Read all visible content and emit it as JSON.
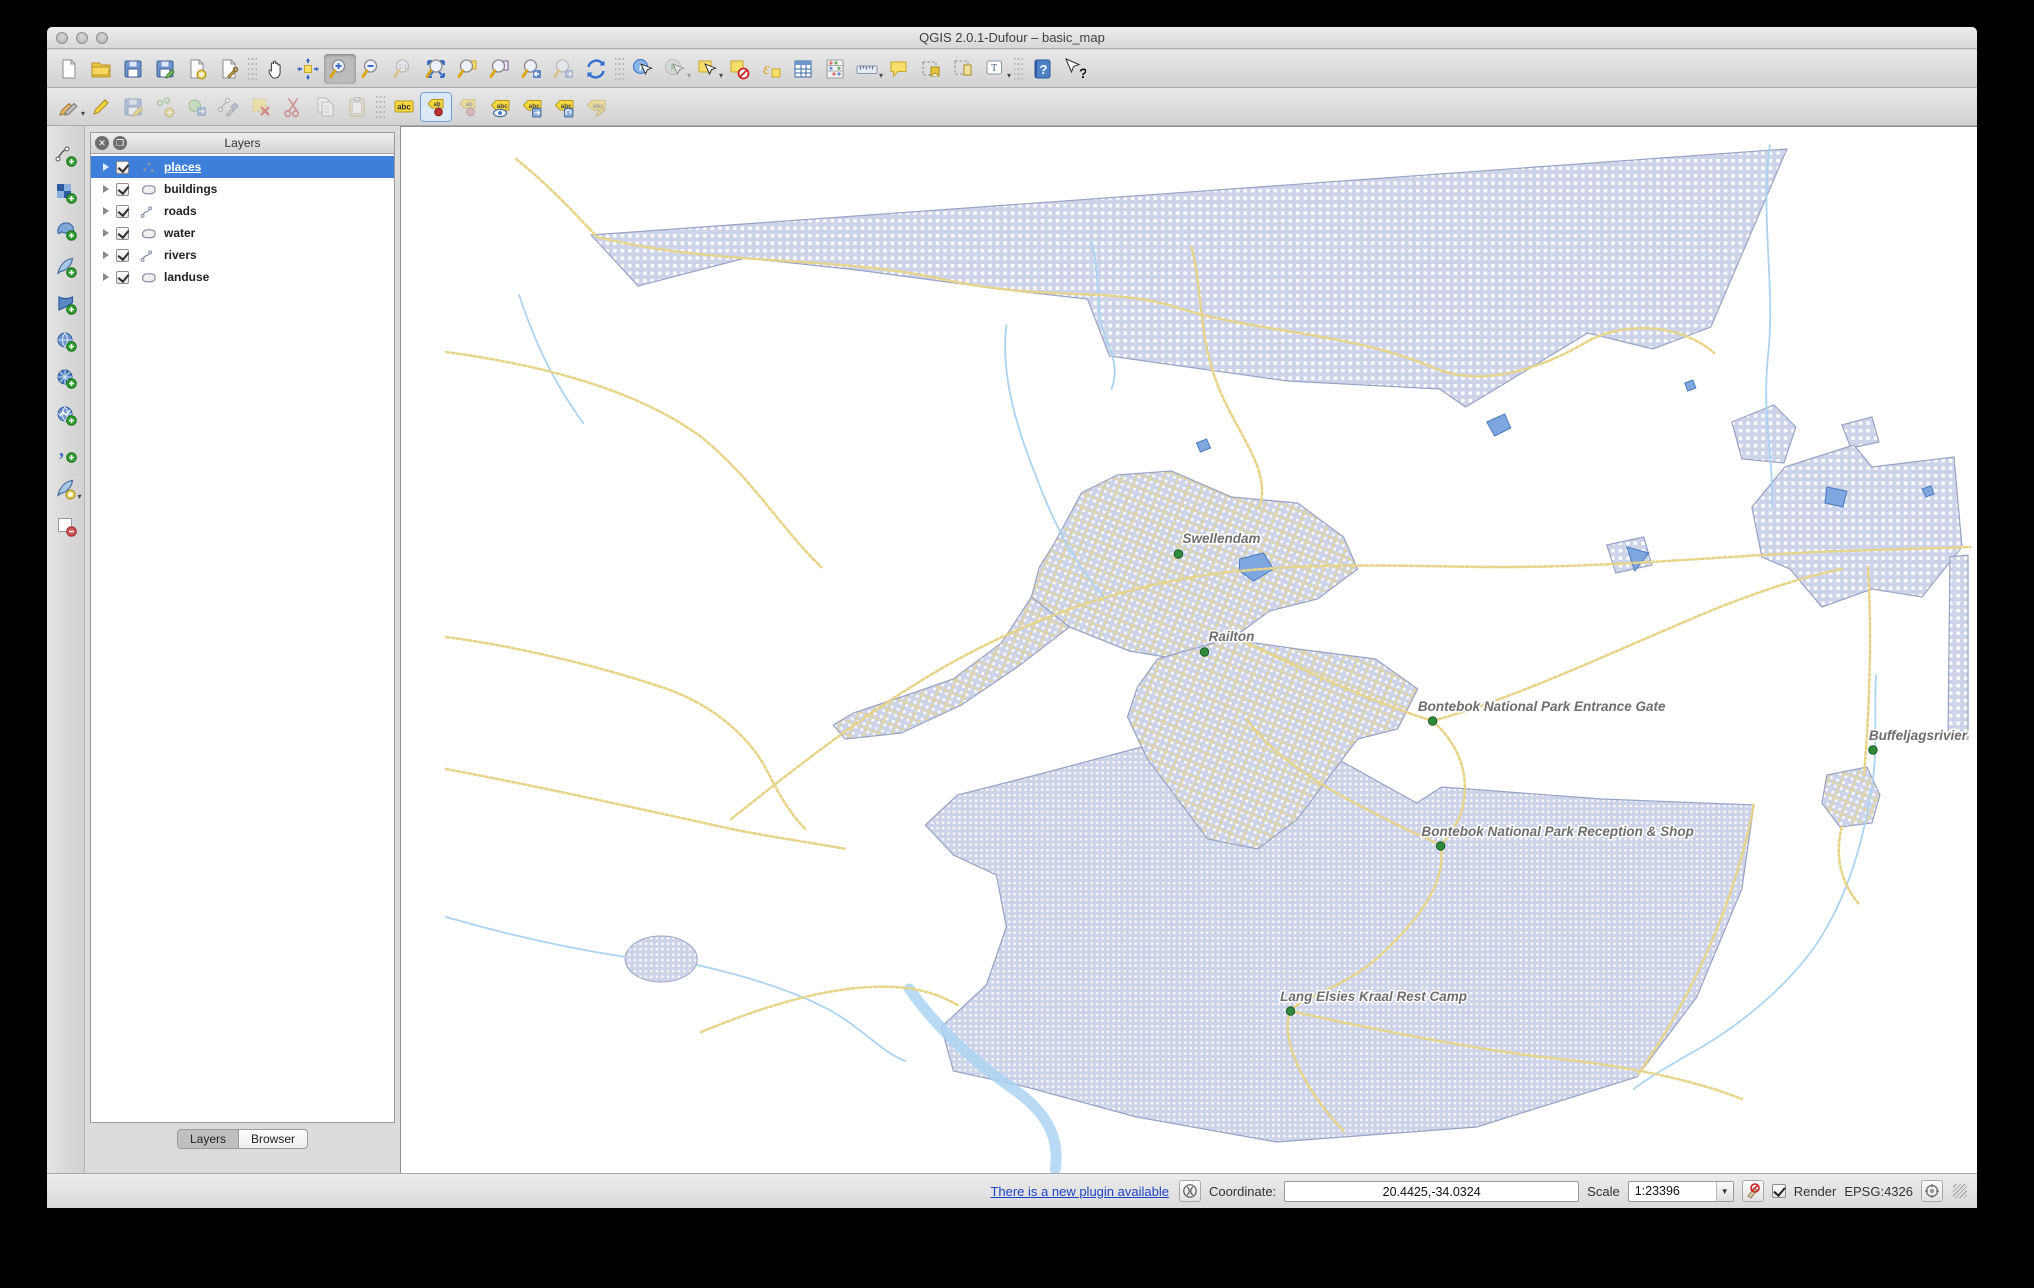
{
  "window": {
    "title": "QGIS 2.0.1-Dufour – basic_map"
  },
  "toolbar_row1": [
    {
      "name": "new-project"
    },
    {
      "name": "open-project"
    },
    {
      "name": "save-project"
    },
    {
      "name": "save-project-as"
    },
    {
      "name": "new-print-composer"
    },
    {
      "name": "composer-manager"
    },
    {
      "sep": true
    },
    {
      "name": "pan-map"
    },
    {
      "name": "pan-to-selection"
    },
    {
      "name": "zoom-in",
      "active": true
    },
    {
      "name": "zoom-out"
    },
    {
      "name": "zoom-native",
      "disabled": true
    },
    {
      "name": "zoom-full"
    },
    {
      "name": "zoom-to-selection"
    },
    {
      "name": "zoom-to-layer"
    },
    {
      "name": "zoom-last"
    },
    {
      "name": "zoom-next",
      "disabled": true
    },
    {
      "name": "refresh-map"
    },
    {
      "sep": true
    },
    {
      "name": "identify-features"
    },
    {
      "name": "run-feature-action",
      "disabled": true,
      "dropdown": true
    },
    {
      "name": "select-features",
      "dropdown": true
    },
    {
      "name": "deselect-features"
    },
    {
      "name": "select-by-expression"
    },
    {
      "name": "open-attribute-table"
    },
    {
      "name": "field-calculator"
    },
    {
      "name": "measure",
      "dropdown": true
    },
    {
      "name": "map-tips"
    },
    {
      "name": "new-bookmark"
    },
    {
      "name": "show-bookmarks"
    },
    {
      "name": "text-annotation",
      "dropdown": true
    },
    {
      "sep": true
    },
    {
      "name": "help-contents"
    },
    {
      "name": "whats-this"
    }
  ],
  "toolbar_row2": [
    {
      "name": "current-edits",
      "dropdown": true
    },
    {
      "name": "toggle-editing"
    },
    {
      "name": "save-layer-edits",
      "disabled": true
    },
    {
      "name": "add-feature",
      "disabled": true
    },
    {
      "name": "move-feature",
      "disabled": true
    },
    {
      "name": "node-tool",
      "disabled": true
    },
    {
      "name": "delete-selected",
      "disabled": true
    },
    {
      "name": "cut-features",
      "disabled": true
    },
    {
      "name": "copy-features",
      "disabled": true
    },
    {
      "name": "paste-features",
      "disabled": true
    },
    {
      "sep": true
    },
    {
      "name": "layer-labeling-options"
    },
    {
      "name": "pin-labels",
      "framed": true
    },
    {
      "name": "highlight-pinned-labels",
      "disabled": true
    },
    {
      "name": "show-hide-labels"
    },
    {
      "name": "move-label"
    },
    {
      "name": "rotate-label"
    },
    {
      "name": "change-label",
      "disabled": true
    }
  ],
  "side_toolbar": [
    {
      "name": "add-vector-layer"
    },
    {
      "name": "add-raster-layer"
    },
    {
      "name": "add-postgis-layer"
    },
    {
      "name": "add-spatialite-layer"
    },
    {
      "name": "add-mssql-layer"
    },
    {
      "name": "add-wms-layer"
    },
    {
      "name": "add-wcs-layer"
    },
    {
      "name": "add-wfs-layer"
    },
    {
      "name": "add-delimited-text-layer"
    },
    {
      "name": "new-shapefile-layer",
      "dropdown": true
    },
    {
      "name": "remove-layer"
    }
  ],
  "layers_panel": {
    "title": "Layers",
    "layers": [
      {
        "label": "places",
        "type": "point",
        "checked": true,
        "selected": true
      },
      {
        "label": "buildings",
        "type": "polygon",
        "checked": true
      },
      {
        "label": "roads",
        "type": "line",
        "checked": true
      },
      {
        "label": "water",
        "type": "polygon",
        "checked": true
      },
      {
        "label": "rivers",
        "type": "line",
        "checked": true
      },
      {
        "label": "landuse",
        "type": "polygon",
        "checked": true
      }
    ],
    "tabs": [
      {
        "label": "Layers",
        "active": true
      },
      {
        "label": "Browser",
        "active": false
      }
    ]
  },
  "status_bar": {
    "plugin_link": "There is a new plugin available",
    "coordinate_label": "Coordinate:",
    "coordinate_value": "20.4425,-34.0324",
    "scale_label": "Scale",
    "scale_value": "1:23396",
    "render_label": "Render",
    "render_checked": true,
    "crs": "EPSG:4326"
  },
  "map": {
    "colors": {
      "background": "#ffffff",
      "landuse_fill": "#cdd4ea",
      "landuse_border": "#98a2c6",
      "road": "#e7d489",
      "river": "#abd3f2",
      "water_fill": "#7ea7e0",
      "water_border": "#4a79c0",
      "label": "#6e6e6e",
      "label_halo": "#ffffff",
      "place_dot": "#2e8b3a"
    },
    "landuse_paths": [
      "M190,108 L1385,22 L1309,200 L1251,222 L1186,206 L1064,280 L1038,262 L886,254 L708,229 L686,172 L606,163 L456,143 L344,131 L237,159 Z",
      "M1330,295 L1372,278 L1394,300 L1382,336 L1340,332 Z",
      "M1440,298 L1470,290 L1477,315 L1449,321 Z",
      "M1383,340 L1452,318 L1470,340 L1552,330 L1560,420 L1520,470 L1470,462 L1420,480 L1388,442 L1360,430 L1350,380 Z",
      "M1548,430 L1566,428 L1566,612 L1546,614 Z",
      "M1205,418 L1242,410 L1250,438 L1214,446 Z"
    ],
    "park_paths": [
      "M695,632 L845,592 L900,612 L1015,676 L1040,660 L1200,672 L1352,678 L1340,762 L1295,870 L1235,950 L1075,1000 L875,1015 L735,990 L625,960 L552,944 L540,900 L585,858 L605,800 L595,748 L552,728 L524,698 L556,668 L635,648 Z"
    ],
    "town_paths": [
      "M652,418 L680,366 L716,348 L770,344 L830,370 L896,376 L942,410 L956,442 L916,472 L868,484 L830,512 L788,534 L728,524 L668,500 L630,470 L638,440 Z",
      "M668,500 L616,540 L560,578 L500,606 L444,612 L432,598 L452,586 L500,570 L552,552 L600,516 L630,470 Z",
      "M756,532 L826,512 L896,522 L974,532 L1016,562 L996,602 L956,612 L926,652 L896,692 L856,722 L806,712 L776,672 L746,632 L726,590 L736,560 Z",
      "M1425,648 L1465,640 L1478,668 L1470,696 L1438,700 L1420,676 Z"
    ],
    "water_paths": [
      "M1085,295 l18,-8 6,14 -16,8 Z",
      "M1225,420 l22,6 -14,18 Z",
      "M1425,360 l20,4 -4,16 -18,-4 Z",
      "M838,432 l24,-6 10,16 -20,12 -14,-10 Z",
      "M795,316 l10,-4 4,9 -10,4 Z",
      "M1283,256 l8,-3 3,8 -8,3 Z",
      "M1520,362 l9,-3 3,8 -8,3 Z"
    ],
    "river_paths": [
      "M690,115 C700,150 692,185 706,215 C716,238 714,252 710,262",
      "M605,198 C598,258 622,318 642,368 C662,418 684,448 702,470",
      "M1368,18 C1358,90 1374,160 1366,230 C1360,290 1372,330 1370,380",
      "M1474,548 C1472,590 1476,620 1470,660 C1462,710 1448,760 1425,800 C1400,846 1350,890 1300,920 C1268,938 1245,952 1232,962",
      "M45,790 C100,806 160,820 224,830",
      "M296,838 C340,848 390,862 430,884 C462,902 480,925 504,934",
      "M118,168 C132,210 150,252 182,296"
    ],
    "wide_river_paths": [
      "M508,862 C536,902 572,934 612,962 C646,986 658,1010 654,1042"
    ],
    "road_paths": [
      "M115,32 C150,60 175,88 196,110",
      "M196,110 C320,140 430,128 540,152 C650,176 710,158 780,182 C860,206 950,206 1030,240 C1080,262 1140,242 1190,212",
      "M1190,212 C1240,190 1290,205 1312,226",
      "M45,225 C140,238 235,262 300,310 C352,352 380,402 420,440",
      "M45,510 C120,520 200,540 260,560 C310,576 350,610 368,648 C380,672 392,690 404,702",
      "M330,692 C420,620 500,560 580,520 C660,480 740,456 820,446 C920,434 1020,440 1100,440 C1220,440 1330,428 1440,424 L1568,420",
      "M838,512 C910,548 980,578 1031,594",
      "M1031,594 C1056,616 1072,650 1058,690 C1050,706 1044,712 1039,719",
      "M1031,594 C1110,572 1200,530 1280,496 C1330,474 1390,452 1440,442",
      "M845,592 C880,640 940,670 1000,700 C1020,710 1034,714 1039,719",
      "M1039,719 C1046,760 1010,800 970,836 C930,866 900,870 889,884 C878,910 900,960 942,1004",
      "M1352,678 C1336,760 1300,856 1236,948",
      "M889,884 C960,900 1060,920 1140,930 C1220,938 1290,952 1340,972",
      "M45,642 C140,660 240,682 330,702 C370,710 412,716 445,722",
      "M790,120 C800,160 798,200 810,240 C820,275 838,300 852,330 C862,352 862,368 858,380",
      "M1466,440 C1470,500 1468,580 1462,648",
      "M1440,700 C1432,730 1440,758 1458,778",
      "M300,905 C360,880 420,862 470,860 C510,858 536,866 556,878"
    ],
    "places": [
      {
        "name": "Swellendam",
        "dot": [
          777,
          427
        ],
        "label": [
          820,
          416
        ]
      },
      {
        "name": "Railton",
        "dot": [
          803,
          525
        ],
        "label": [
          830,
          514
        ]
      },
      {
        "name": "Bontebok National Park Entrance Gate",
        "dot": [
          1031,
          594
        ],
        "label": [
          1140,
          584
        ]
      },
      {
        "name": "Buffeljagsrivier",
        "dot": [
          1471,
          623
        ],
        "label": [
          1516,
          613
        ]
      },
      {
        "name": "Bontebok National Park Reception & Shop",
        "dot": [
          1039,
          719
        ],
        "label": [
          1156,
          709
        ]
      },
      {
        "name": "Lang Elsies Kraal Rest Camp",
        "dot": [
          889,
          884
        ],
        "label": [
          972,
          874
        ]
      }
    ],
    "pond": {
      "cx": 260,
      "cy": 832,
      "rx": 36,
      "ry": 23
    }
  }
}
